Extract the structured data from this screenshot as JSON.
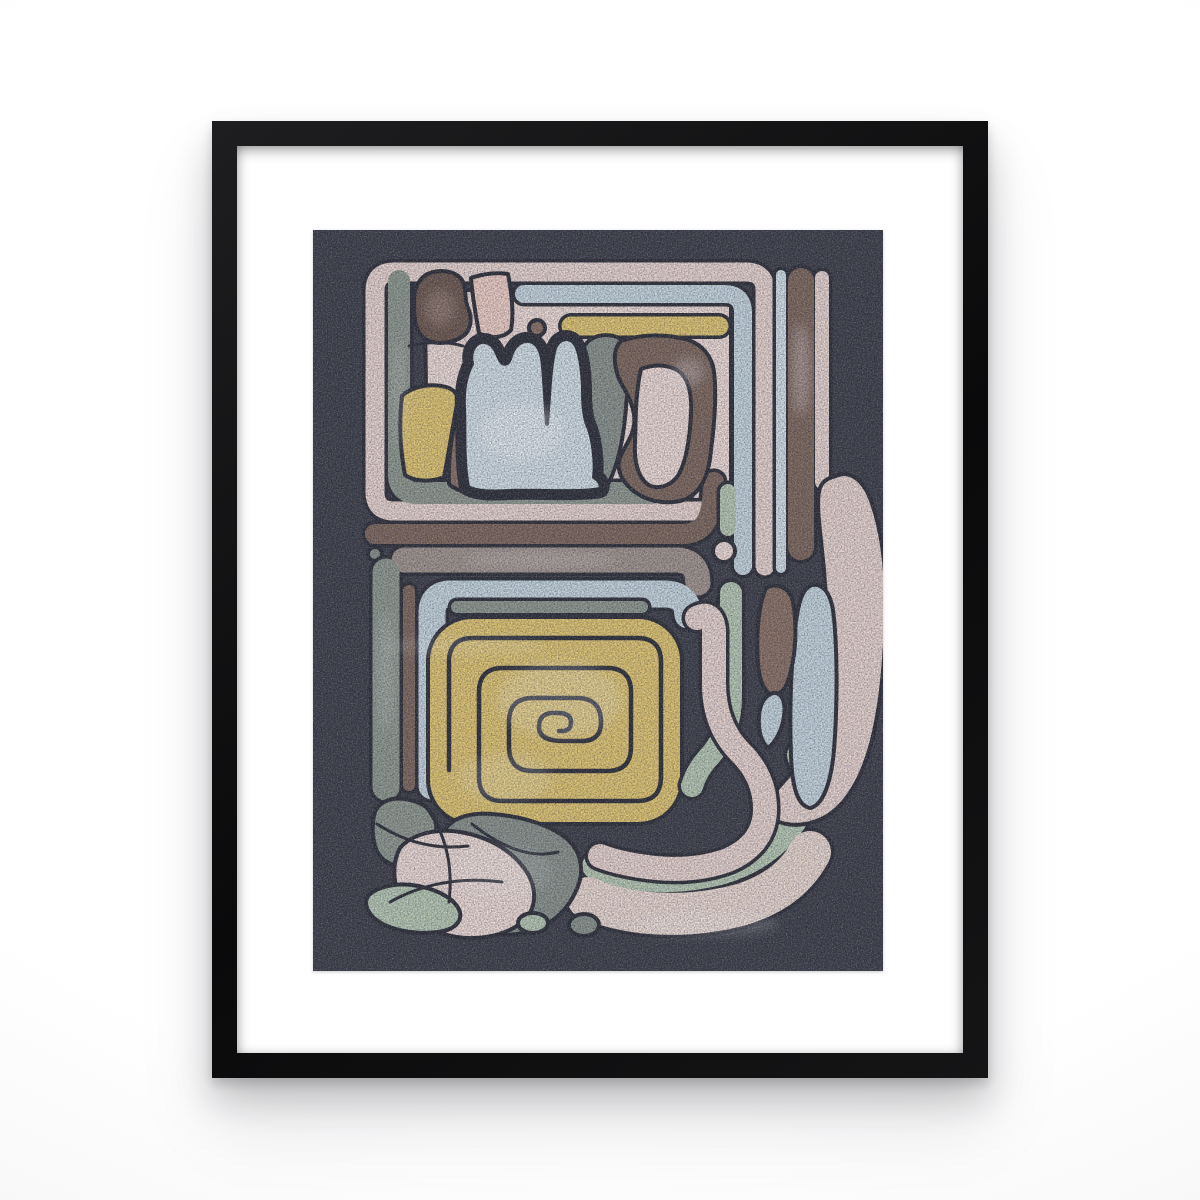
{
  "scene": {
    "type": "product photo of a framed wall poster",
    "subject": "Abstract composition poster in a black frame with a white mat, hanging on a white wall",
    "art_style": "abstract pre-Columbian glyph motifs: nested rounded bands, square spiral, organic pebble shapes on dark grainy background"
  },
  "frame": {
    "frame_color": "#121213",
    "mat_color": "#ffffff",
    "wall_color": "#fbfbfc"
  },
  "artwork": {
    "background": "#42444b",
    "outline": "#33353b",
    "palette": {
      "ink": "#33353b",
      "pink": "#e7d5cd",
      "pink_light": "#eddcd4",
      "salmon": "#edcfc3",
      "cream": "#e9d9ce",
      "blue": "#c6d6dc",
      "blue_light": "#d3e0e4",
      "yellow": "#dfc672",
      "sage": "#b7c9b2",
      "gray_green": "#909a8e",
      "gray_mid": "#8b948b",
      "taupe": "#a1968d",
      "brown": "#7f6b5e",
      "brown_dark": "#6f5c50",
      "brown_mid": "#8b7466",
      "mottle_white": "#f4ece5"
    }
  }
}
